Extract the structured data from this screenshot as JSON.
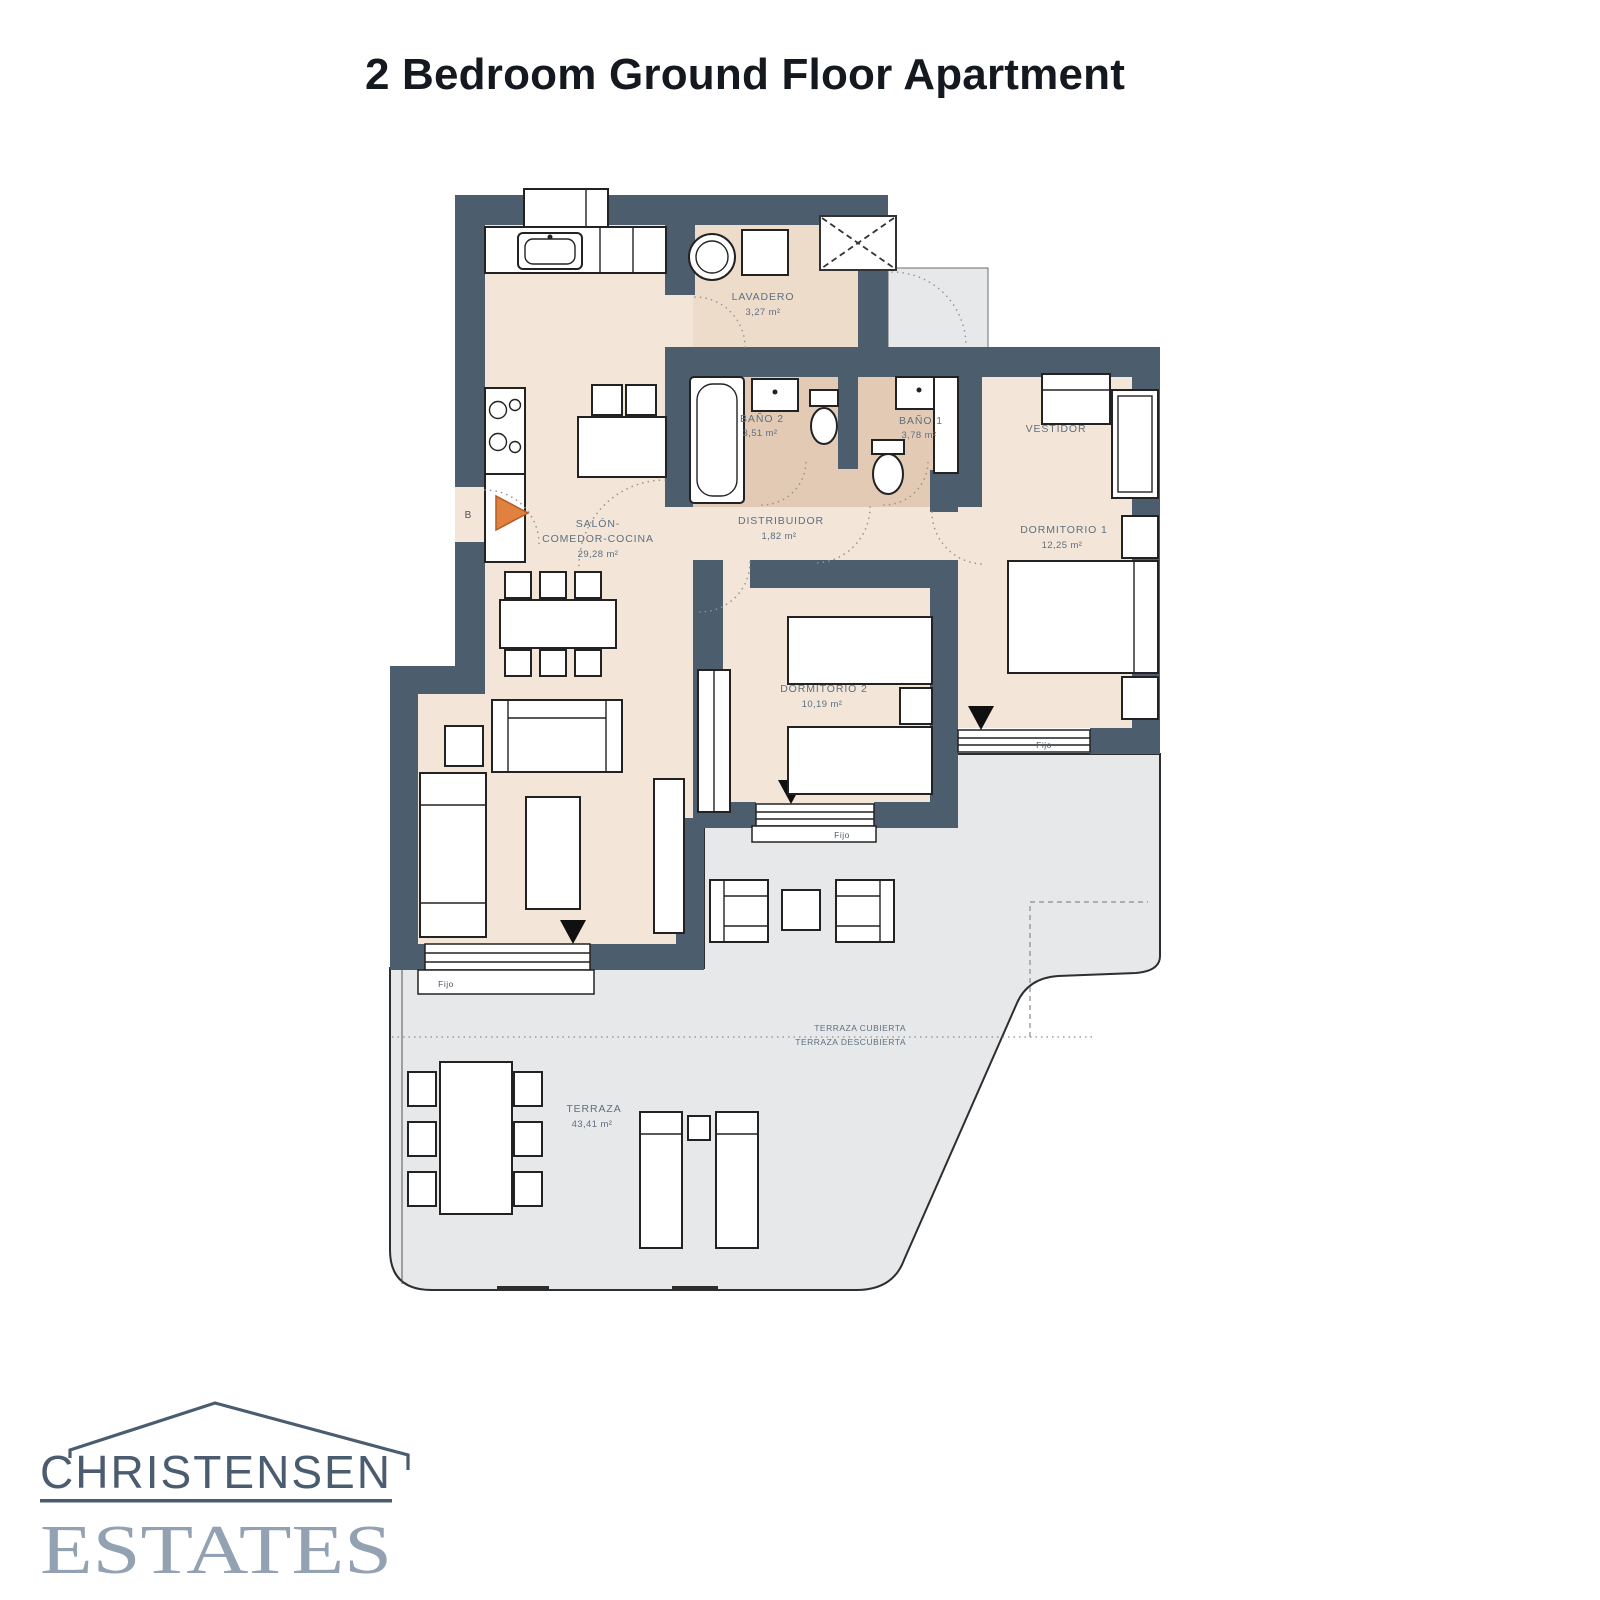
{
  "page": {
    "title": "2 Bedroom Ground Floor Apartment"
  },
  "plan": {
    "rooms": [
      {
        "name": "LAVADERO",
        "area": "3,27 m²"
      },
      {
        "name": "BAÑO 2",
        "area": "3,51 m²"
      },
      {
        "name": "BAÑO 1",
        "area": "3,78 m²"
      },
      {
        "name": "VESTIDOR",
        "area": ""
      },
      {
        "name": "DISTRIBUIDOR",
        "area": "1,82 m²"
      },
      {
        "name": "SALÓN-",
        "name_line2": "COMEDOR-COCINA",
        "area": "29,28 m²"
      },
      {
        "name": "DORMITORIO 1",
        "area": "12,25 m²"
      },
      {
        "name": "DORMITORIO 2",
        "area": "10,19 m²"
      },
      {
        "name": "TERRAZA",
        "area": "43,41 m²"
      }
    ],
    "annotations": {
      "terrace_covered": "TERRAZA CUBIERTA",
      "terrace_uncovered": "TERRAZA DESCUBIERTA",
      "window_label": "Fijo",
      "entrance_label": "B"
    }
  },
  "logo": {
    "line1": "CHRISTENSEN",
    "line2": "ESTATES"
  },
  "colors": {
    "title": "#14181f",
    "wall": "#4c5d6d",
    "floor": "#f3e5d7",
    "bath": "#e3cab4",
    "lav": "#eedccb",
    "terrace": "#e7e8ea",
    "label": "#5d7082",
    "arrow": "#e0813f",
    "logo_primary": "#4a5c6f",
    "logo_secondary": "#93a2b2"
  }
}
